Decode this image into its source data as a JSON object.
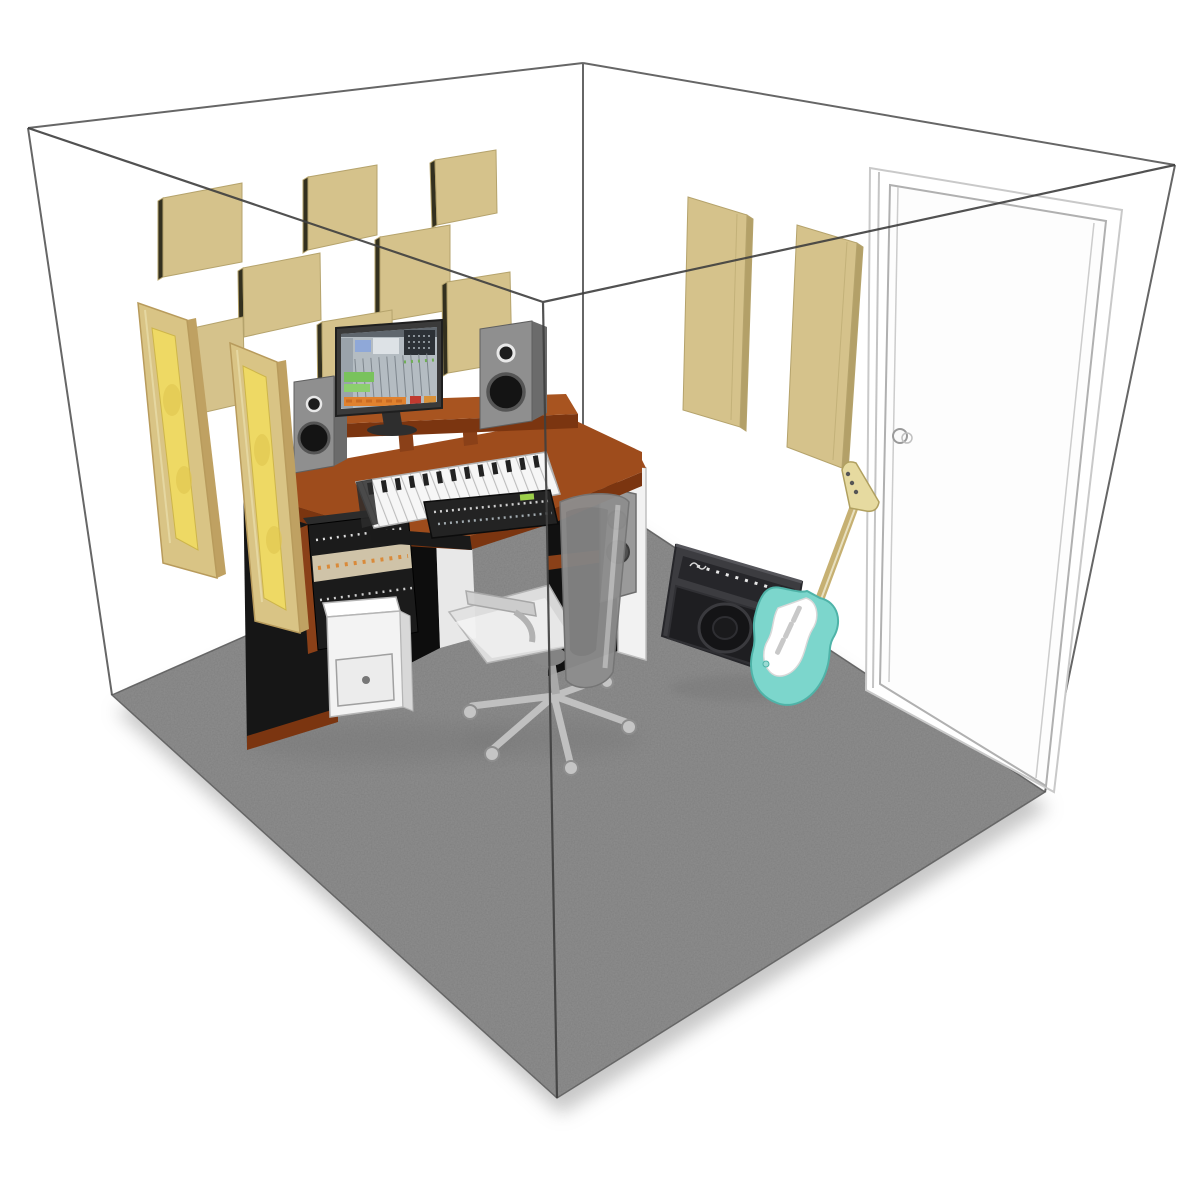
{
  "scene": {
    "title": "3D cutaway illustration of a home recording studio room with acoustic treatment",
    "room": {
      "walls": "white walls drawn as a transparent wireframe cube",
      "floor": "gray carpet",
      "door": "white door on right wall with round knob"
    },
    "objects": [
      {
        "name": "acoustic-panel-grid",
        "description": "checkerboard of 8 square beige acoustic panels on back-left wall"
      },
      {
        "name": "corner-bass-traps",
        "description": "2 tall wood-framed yellow bass trap panels hung in the back corner"
      },
      {
        "name": "right-wall-panels",
        "description": "2 vertical beige absorber panels on back-right wall"
      },
      {
        "name": "studio-desk",
        "description": "cherry wood corner workstation with black side cabinets and raised monitor bridge"
      },
      {
        "name": "computer-monitor",
        "description": "widescreen monitor showing colorful DAW mixing software"
      },
      {
        "name": "studio-speakers",
        "description": "2 gray nearfield monitor speakers"
      },
      {
        "name": "midi-keyboard",
        "description": "white 61-key MIDI keyboard on desktop"
      },
      {
        "name": "mixer-console",
        "description": "black control surface on pull-out tray"
      },
      {
        "name": "rack-gear",
        "description": "angled rack stand with outboard audio units"
      },
      {
        "name": "white-drawer-unit",
        "description": "white cabinet box with drawer under desk"
      },
      {
        "name": "office-chair",
        "description": "gray mesh task chair on casters"
      },
      {
        "name": "guitar-amplifier",
        "description": "black combo guitar amp leaning by right wall"
      },
      {
        "name": "electric-guitar",
        "description": "seafoam green electric guitar leaning against the wall"
      },
      {
        "name": "pc-tower",
        "description": "gray computer tower beside desk"
      }
    ],
    "counts": {
      "square_panels": 8,
      "corner_bass_traps": 2,
      "right_wall_panels": 2
    }
  },
  "colors": {
    "background": "#ffffff",
    "wireframe": "#4f4f4f",
    "floor": "#8f8f8f",
    "panel_beige": "#d5c28b",
    "panel_edge": "#33301f",
    "trap_frame": "#d9c485",
    "trap_fill": "#eed964",
    "wood_top": "#9e4c1c",
    "wood_edge": "#7b3510",
    "black_panel": "#161616",
    "speaker_gray": "#8f8f8f",
    "door_white": "#fdfdfd",
    "door_line": "#b0b0b0",
    "guitar_teal": "#7cd6cc",
    "amp_dark": "#3c3c40",
    "chair_seat": "#e2e2e2"
  }
}
